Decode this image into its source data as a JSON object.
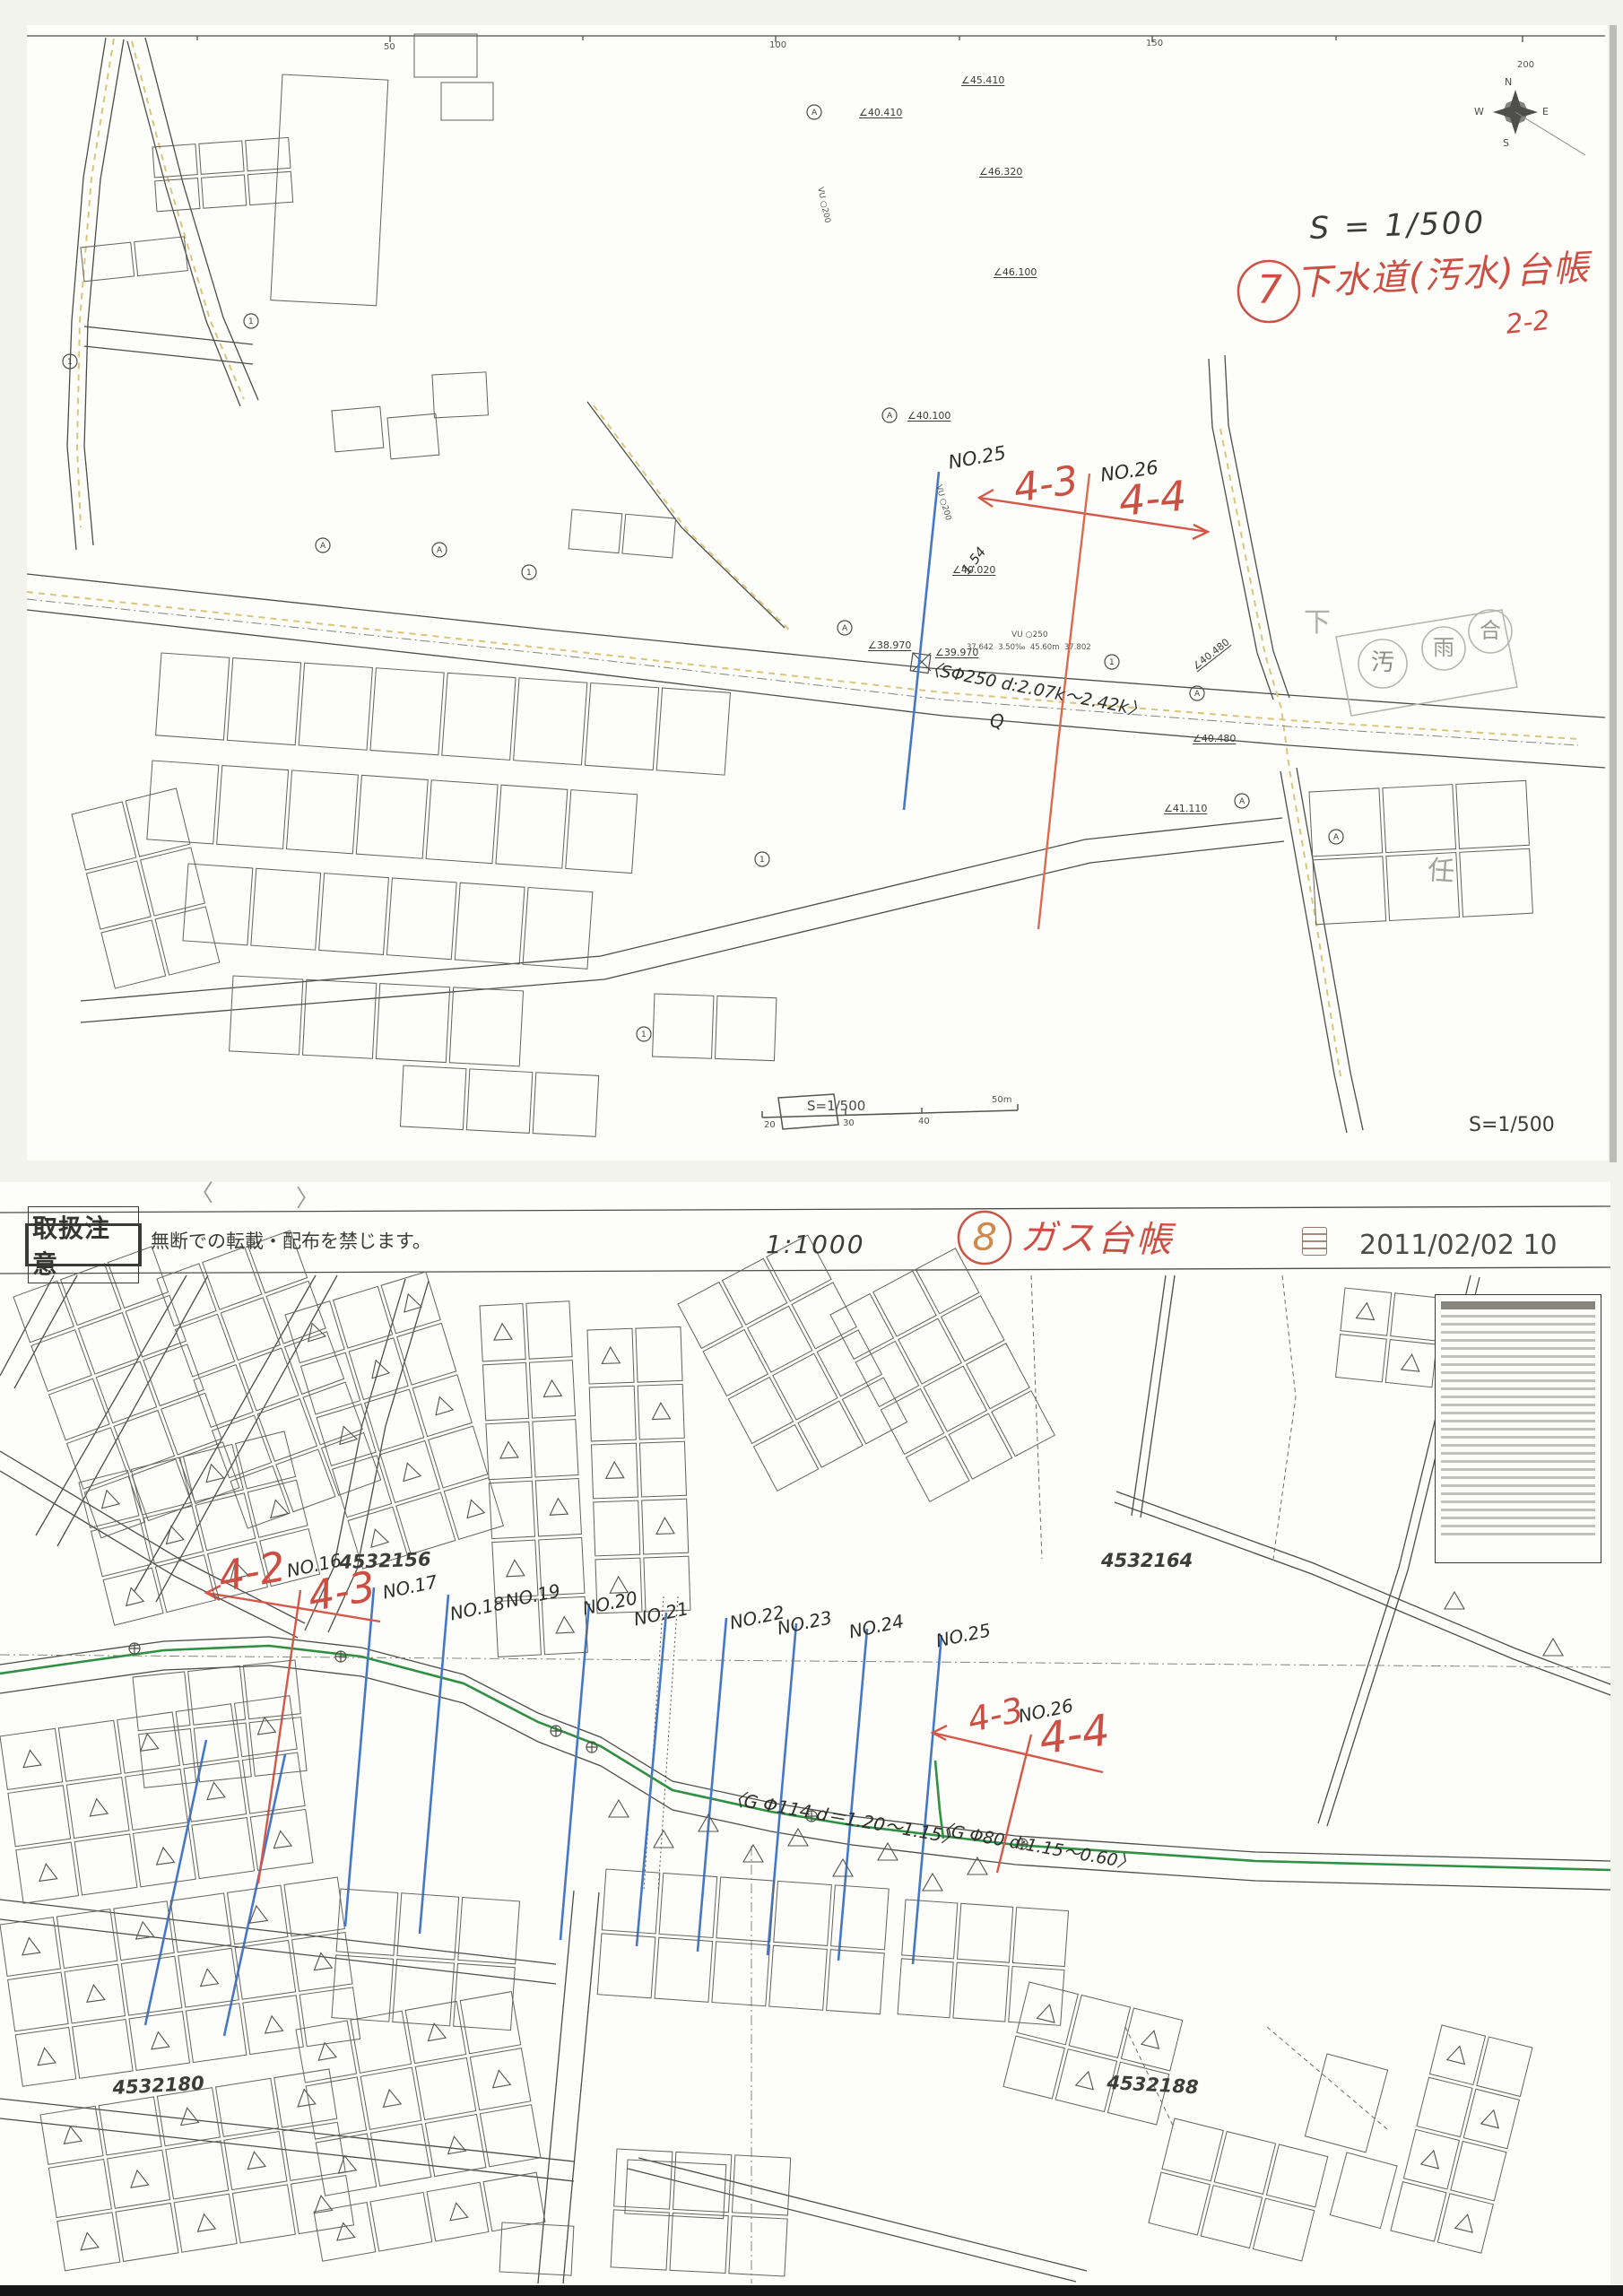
{
  "sheet1": {
    "ruler": [
      "50",
      "100",
      "150",
      "200"
    ],
    "compass": {
      "n": "N",
      "e": "E",
      "s": "S",
      "w": "W"
    },
    "scale_hand": "S = 1/500",
    "index_no": "7",
    "index_title": "下水道(汚水)台帳",
    "index_page": "2-2",
    "red_marks": [
      "4-3",
      "4-4"
    ],
    "hand_notes": [
      "NO.25",
      "NO.26",
      "〈SΦ250 d:2.07k〜2.42k〉",
      "Q",
      "1.54"
    ],
    "pencil_notes": [
      "下",
      "汚",
      "雨",
      "合",
      "任"
    ],
    "printed_labels": [
      "∠40.410",
      "∠45.410",
      "∠46.320",
      "∠46.100",
      "∠40.100",
      "∠40.020",
      "∠39.970",
      "∠38.970",
      "∠40.480",
      "∠40.480",
      "∠41.110",
      "VU ○250",
      "37.642  3.50‰  45.60m  37.802",
      "VU ○200",
      "VU ○200"
    ],
    "scale_printed": "S=1/500",
    "scale_bar": [
      "20",
      "30",
      "40",
      "50m"
    ],
    "scale_printed_right": "S=1/500"
  },
  "sheet2": {
    "fold_marks": [
      "〈",
      "〉"
    ],
    "header": {
      "caution_stamp": "取扱注意",
      "caution_note": "無断での転載・配布を禁じます。",
      "scale": "1:1000",
      "index_no": "8",
      "index_title": "ガス台帳",
      "datetime": "2011/02/02 10"
    },
    "red_marks": [
      "4-2",
      "4-3",
      "4-3",
      "4-4"
    ],
    "survey_points": [
      "NO.16",
      "NO.17",
      "NO.18",
      "NO.19",
      "NO.20",
      "NO.21",
      "NO.22",
      "NO.23",
      "NO.24",
      "NO.25",
      "NO.26"
    ],
    "pipe_notes": [
      "〈G Φ114 d＝1.20〜1.15〉",
      "〈G Φ80 d:1.15〜0.60〉"
    ],
    "parcel_numbers": [
      "4532156",
      "4532164",
      "4532180",
      "4532188"
    ]
  }
}
